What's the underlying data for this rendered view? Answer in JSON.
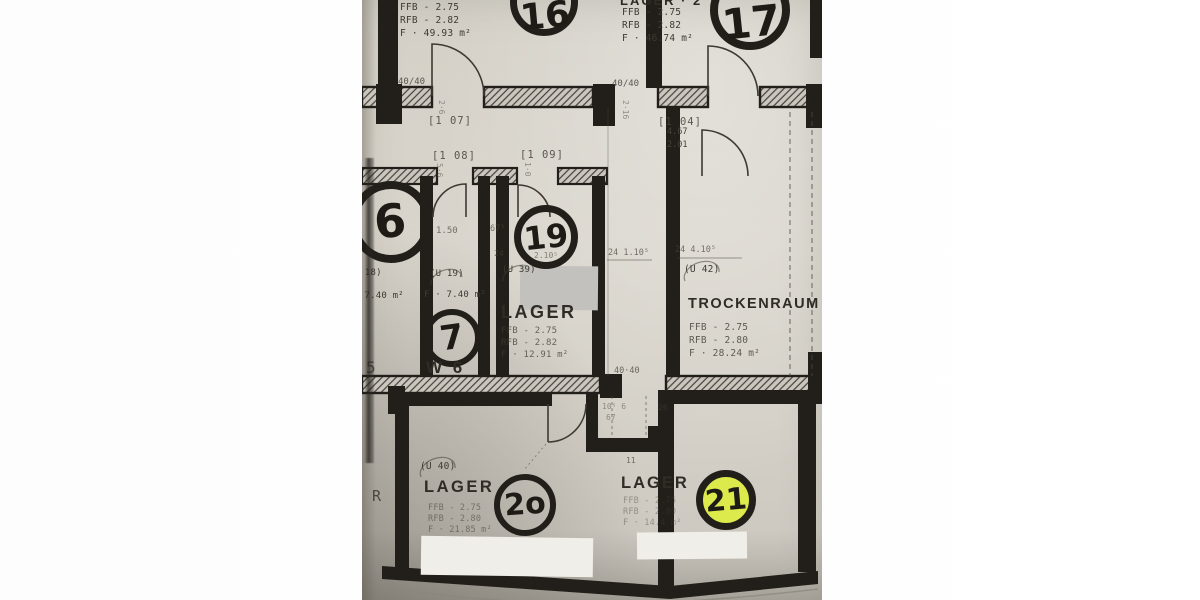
{
  "photo": {
    "description": "photocopied basement floor plan, photographed",
    "paper_color": "#d6d2c9",
    "ink_color": "#221f1a",
    "highlight_color": "#dcea4b"
  },
  "rooms": {
    "room16": {
      "number": "16",
      "specs": [
        "FFB - 2.75",
        "RFB - 2.82",
        "F · 49.93 m²"
      ]
    },
    "room17": {
      "number": "17",
      "name_fragment": "LAGER · 2",
      "specs": [
        "FFB - 2.75",
        "RFB - 2.82",
        "F · 46.74 m²"
      ]
    },
    "room6": {
      "number": "6",
      "unit_fragment": "(U 18)",
      "area_fragment": "F · 7.40 m²"
    },
    "room7": {
      "number": "7",
      "unit": "(U 19)",
      "width_dim": "1.50",
      "area": "F · 7.40 m²",
      "caption": "W 6"
    },
    "room19": {
      "number": "19",
      "unit": "(U 39)",
      "name": "LAGER",
      "specs": [
        "FFB - 2.75",
        "RFB - 2.82",
        "F · 12.91 m²"
      ]
    },
    "trockenraum": {
      "unit": "(U 42)",
      "name": "TROCKENRAUM / ZB",
      "specs": [
        "FFB - 2.75",
        "RFB - 2.80",
        "F · 28.24 m²"
      ]
    },
    "room20": {
      "number": "2o",
      "unit": "(U 40)",
      "name": "LAGER",
      "specs": [
        "FFB - 2.75",
        "RFB - 2.80",
        "F · 21.85 m²"
      ]
    },
    "room21": {
      "number": "21",
      "name": "LAGER",
      "corner_dim": "11",
      "specs": [
        "FFB - 2.75",
        "RFB - 2.80",
        "F · 14.4 m²"
      ]
    }
  },
  "dims": {
    "wall_left": "40/40",
    "wall_right": "40/40",
    "wall_bottom": "40·40",
    "ref_a": "[1 07]",
    "ref_b": "[1 04]",
    "ref_c": "[1 08]",
    "ref_d": "[1 09]",
    "door_h": "4.67",
    "door_w": "2.01",
    "d675": "67⁵",
    "d24": "24",
    "d210": "2.10⁵",
    "chain_a": "24   1.10⁵",
    "chain_b": "24    4.10⁵",
    "stack_a": "2·6",
    "stack_b": "2·16",
    "stack_c": "5·6",
    "stack_d": "1·0",
    "niche_a": "10⁵ 6",
    "niche_b": "67",
    "niche_c": "26",
    "frag_r": "R",
    "frag_5": "5"
  }
}
